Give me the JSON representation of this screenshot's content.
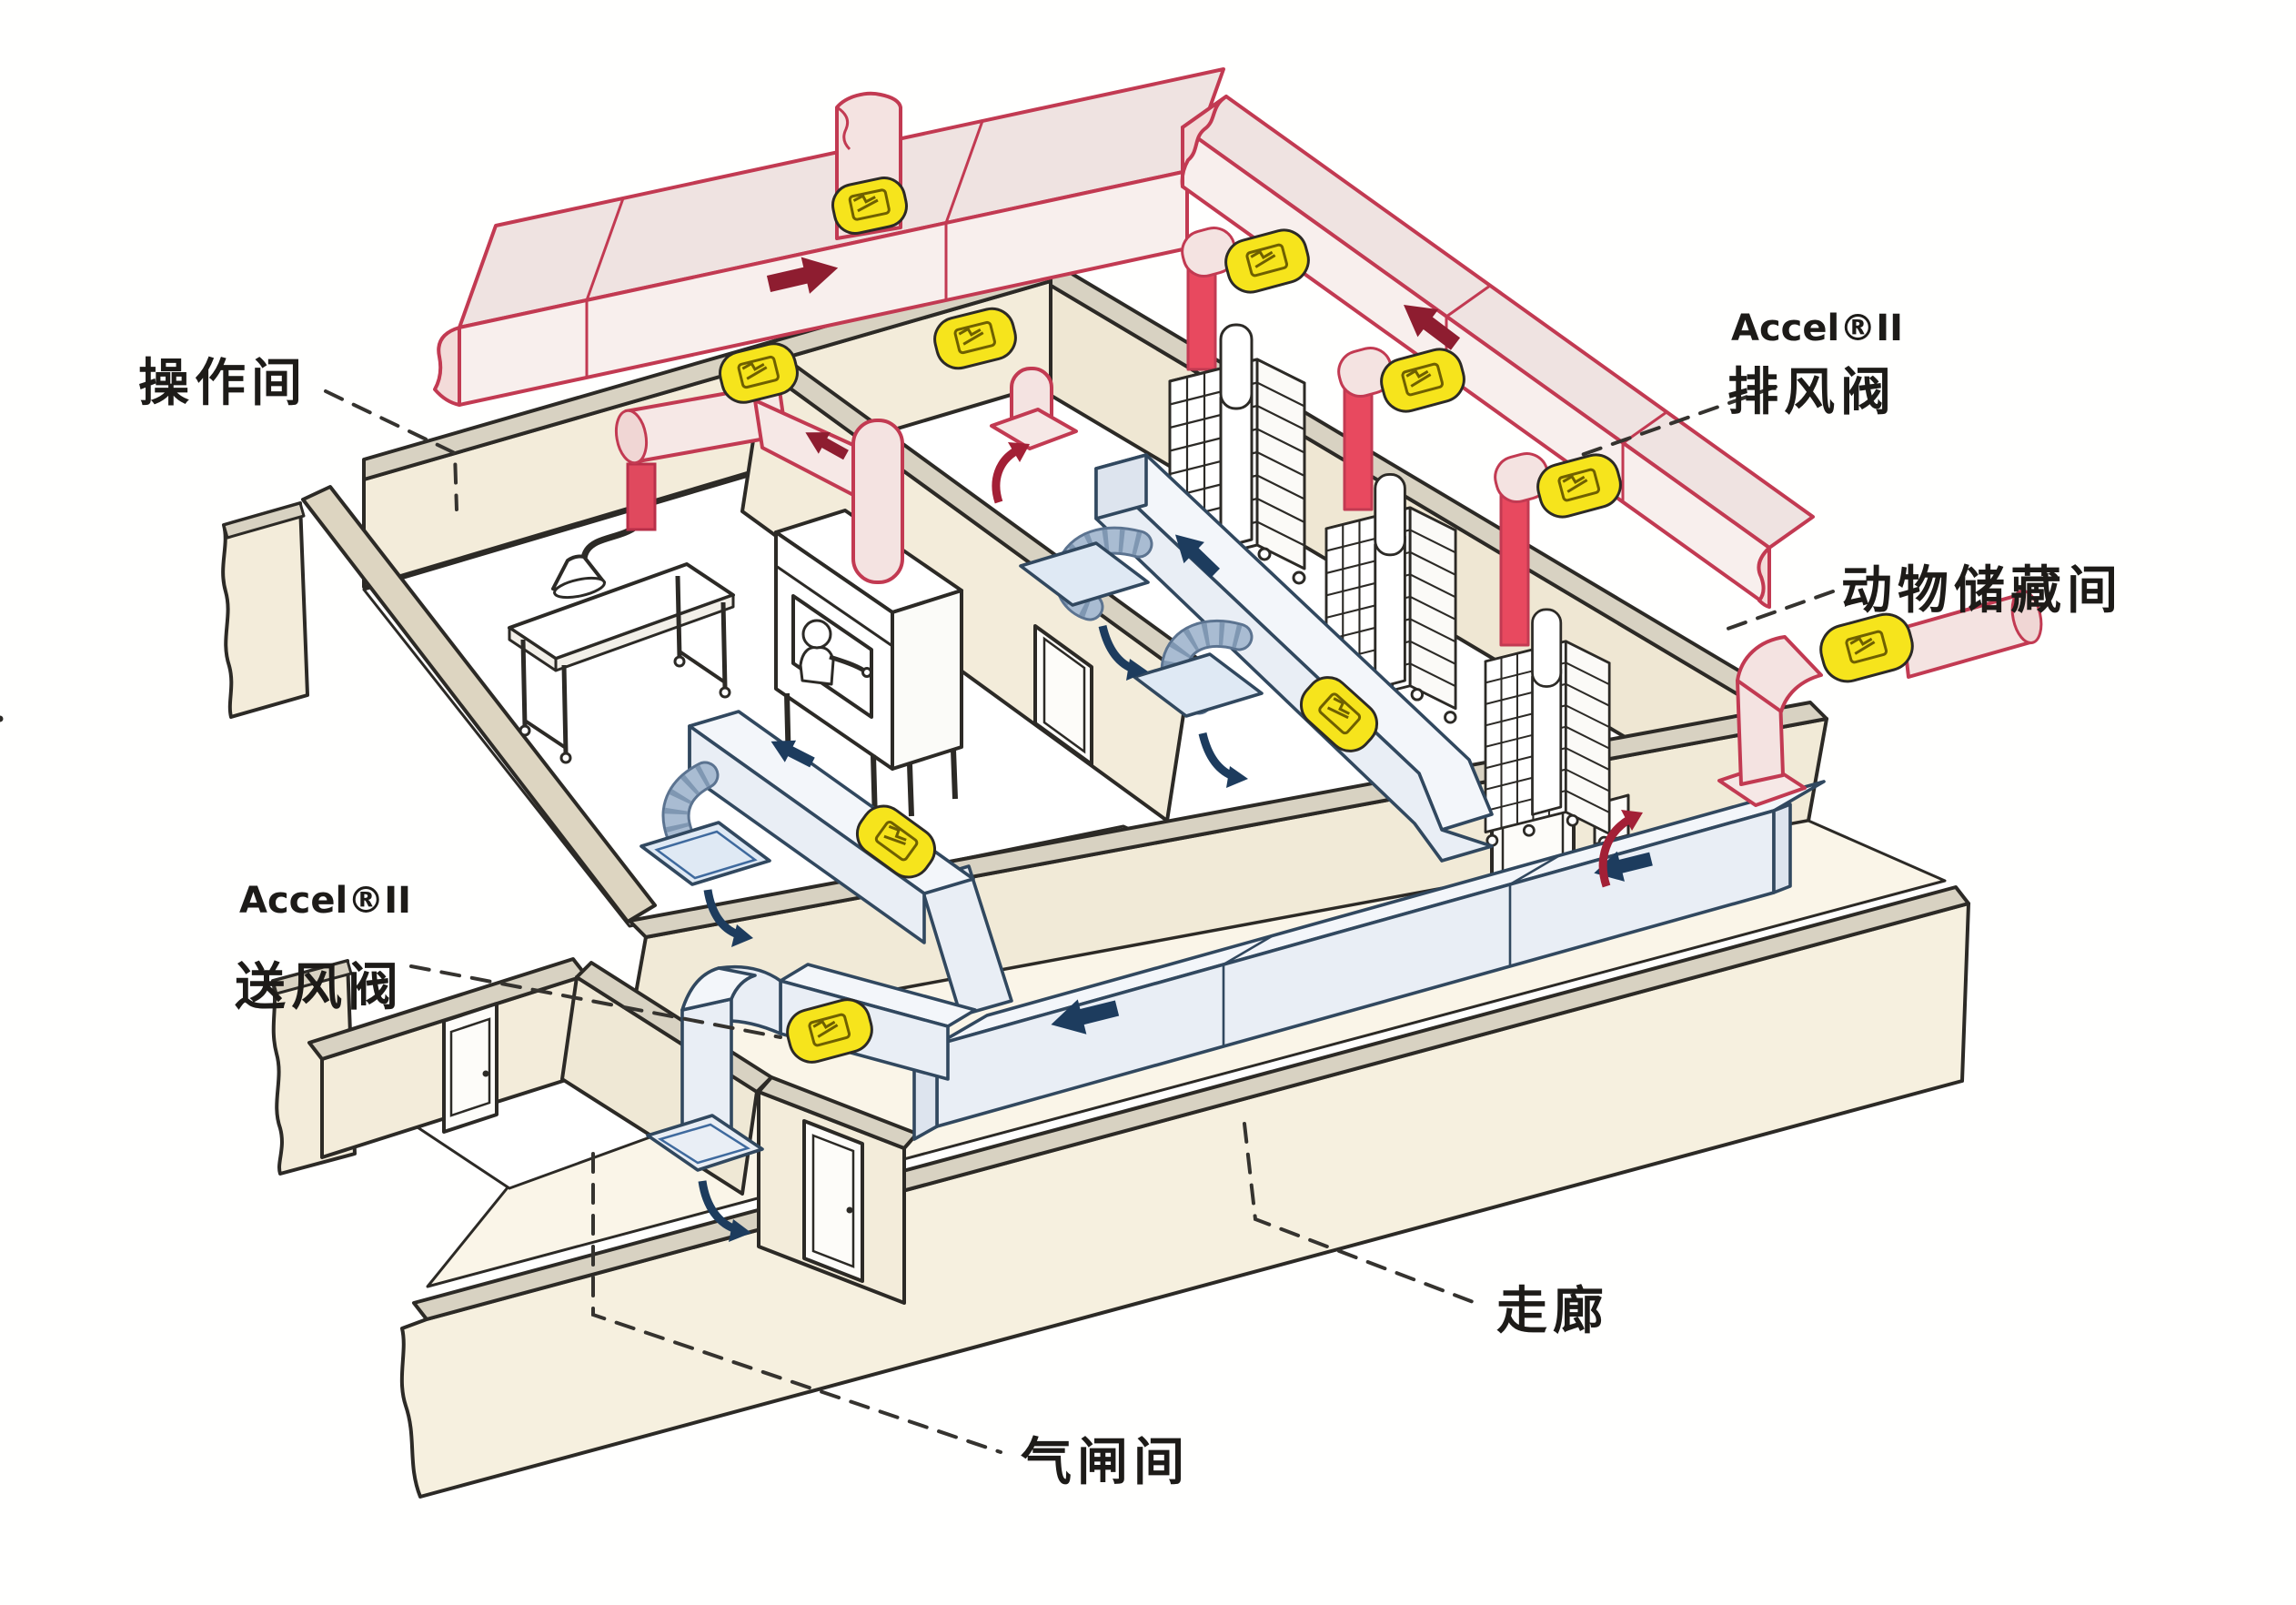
{
  "diagram": {
    "rooms": {
      "operation_room": "操作间",
      "animal_storage_room": "动物储藏间",
      "corridor": "走廊",
      "airlock": "气闸间"
    },
    "valves": {
      "exhaust": {
        "brand": "Accel®II",
        "name": "排风阀"
      },
      "supply": {
        "brand": "Accel®II",
        "name": "送风阀"
      }
    },
    "icons": {
      "exhaust_flow_arrow": "dark-red block arrow",
      "supply_flow_arrow": "navy block arrow",
      "valve_band": "yellow sleeve valve",
      "leader_line": "dashed leader"
    },
    "colors": {
      "exhaust_duct_outline": "#c23a52",
      "exhaust_duct_fill": "#f8efed",
      "exhaust_riser_fill": "#e8495f",
      "exhaust_arrow": "#8e1d30",
      "supply_duct_outline": "#31485f",
      "supply_duct_fill": "#e9eef5",
      "supply_arrow": "#1d3c5e",
      "valve_yellow": "#f6e41c",
      "wall_face": "#f3ecda",
      "wall_top": "#d8d2c2",
      "outline_ink": "#2c2a26"
    }
  }
}
